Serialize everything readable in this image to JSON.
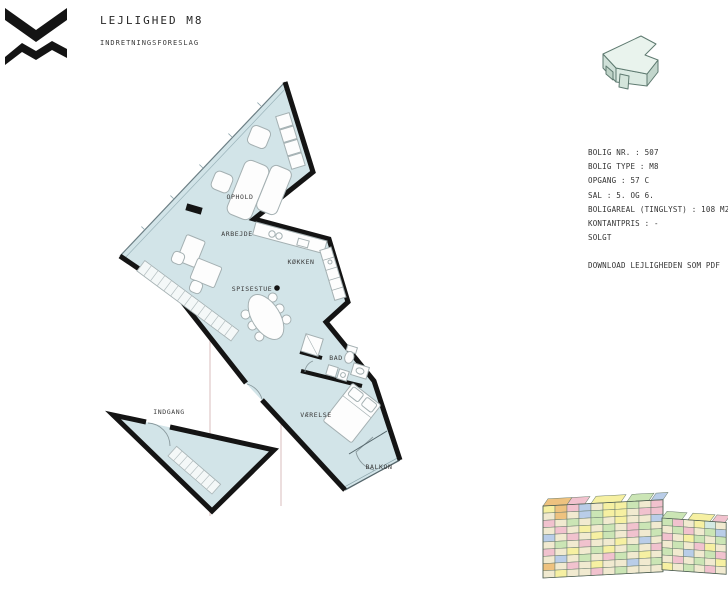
{
  "header": {
    "title": "LEJLIGHED M8",
    "subtitle": "INDRETNINGSFORESLAG",
    "logo_name": "vm-husene-logo"
  },
  "info": {
    "lines": [
      "BOLIG NR. : 507",
      "BOLIG TYPE : M8",
      "OPGANG : 57 C",
      "SAL : 5. OG 6.",
      "BOLIGAREAL (TINGLYST) : 108 M2",
      "KONTANTPRIS : -",
      "SOLGT"
    ],
    "download_label": "DOWNLOAD LEJLIGHEDEN SOM PDF"
  },
  "floorplan": {
    "rooms": [
      {
        "label": "OPHOLD",
        "x": 240,
        "y": 199
      },
      {
        "label": "ARBEJDE",
        "x": 237,
        "y": 236
      },
      {
        "label": "KØKKEN",
        "x": 301,
        "y": 264
      },
      {
        "label": "SPISESTUE",
        "x": 252,
        "y": 291
      },
      {
        "label": "BAD",
        "x": 336,
        "y": 360
      },
      {
        "label": "VÆRELSE",
        "x": 316,
        "y": 417
      },
      {
        "label": "BALKON",
        "x": 379,
        "y": 469
      },
      {
        "label": "INDGANG",
        "x": 169,
        "y": 414
      }
    ],
    "colors": {
      "floor": "#d2e4e8",
      "wall": "#141414",
      "section_line": "#d9bcbc",
      "furniture_stroke": "#a4b0b2",
      "label_text": "#3a3a3a"
    }
  },
  "apartment_icon": {
    "name": "apartment-m8-3d-icon",
    "colors": {
      "top": "#e9f3ed",
      "front": "#dcebe3",
      "left": "#cfe0d8",
      "right": "#c2d6cc",
      "outline": "#5e7a70"
    }
  },
  "building_diagram": {
    "name": "vm-building-overview",
    "palette": [
      "#f1ead0",
      "#f6f0a2",
      "#cbe5b5",
      "#f1c2ce",
      "#b9cde8",
      "#eec27f",
      "#d4e9e2"
    ],
    "outline": "#6b7d6e",
    "left_block": {
      "cols": 10,
      "rows": 10,
      "cell_w": 12,
      "cell_h": 7.2,
      "pattern": [
        [
          1,
          5,
          3,
          4,
          0,
          1,
          1,
          2,
          0,
          3
        ],
        [
          0,
          5,
          0,
          4,
          2,
          1,
          1,
          0,
          3,
          3
        ],
        [
          3,
          0,
          2,
          0,
          2,
          0,
          1,
          0,
          0,
          4
        ],
        [
          0,
          3,
          0,
          1,
          0,
          2,
          0,
          3,
          2,
          0
        ],
        [
          4,
          0,
          3,
          0,
          1,
          2,
          0,
          3,
          0,
          2
        ],
        [
          0,
          2,
          0,
          3,
          0,
          0,
          1,
          0,
          4,
          0
        ],
        [
          3,
          0,
          1,
          0,
          2,
          1,
          0,
          2,
          0,
          3
        ],
        [
          0,
          4,
          0,
          2,
          0,
          3,
          2,
          0,
          1,
          0
        ],
        [
          5,
          0,
          3,
          0,
          1,
          0,
          0,
          4,
          0,
          2
        ],
        [
          0,
          1,
          0,
          0,
          3,
          0,
          2,
          0,
          0,
          0
        ]
      ],
      "roof": [
        {
          "x": 0,
          "w": 24,
          "c": 5
        },
        {
          "x": 24,
          "w": 18,
          "c": 3
        },
        {
          "x": 48,
          "w": 30,
          "c": 1
        },
        {
          "x": 84,
          "w": 22,
          "c": 2
        },
        {
          "x": 108,
          "w": 12,
          "c": 4
        }
      ]
    },
    "right_block": {
      "cols": 6,
      "rows": 7,
      "cell_w": 10.7,
      "cell_h": 7.4,
      "pattern": [
        [
          2,
          3,
          0,
          1,
          6,
          0
        ],
        [
          0,
          2,
          3,
          0,
          2,
          4
        ],
        [
          3,
          0,
          1,
          2,
          0,
          2
        ],
        [
          0,
          2,
          0,
          3,
          1,
          0
        ],
        [
          2,
          0,
          4,
          0,
          2,
          3
        ],
        [
          0,
          3,
          0,
          2,
          0,
          1
        ],
        [
          1,
          0,
          2,
          0,
          3,
          0
        ]
      ],
      "roof": [
        {
          "x": 0,
          "w": 20,
          "c": 2
        },
        {
          "x": 26,
          "w": 22,
          "c": 1
        },
        {
          "x": 50,
          "w": 13,
          "c": 3
        }
      ]
    }
  }
}
